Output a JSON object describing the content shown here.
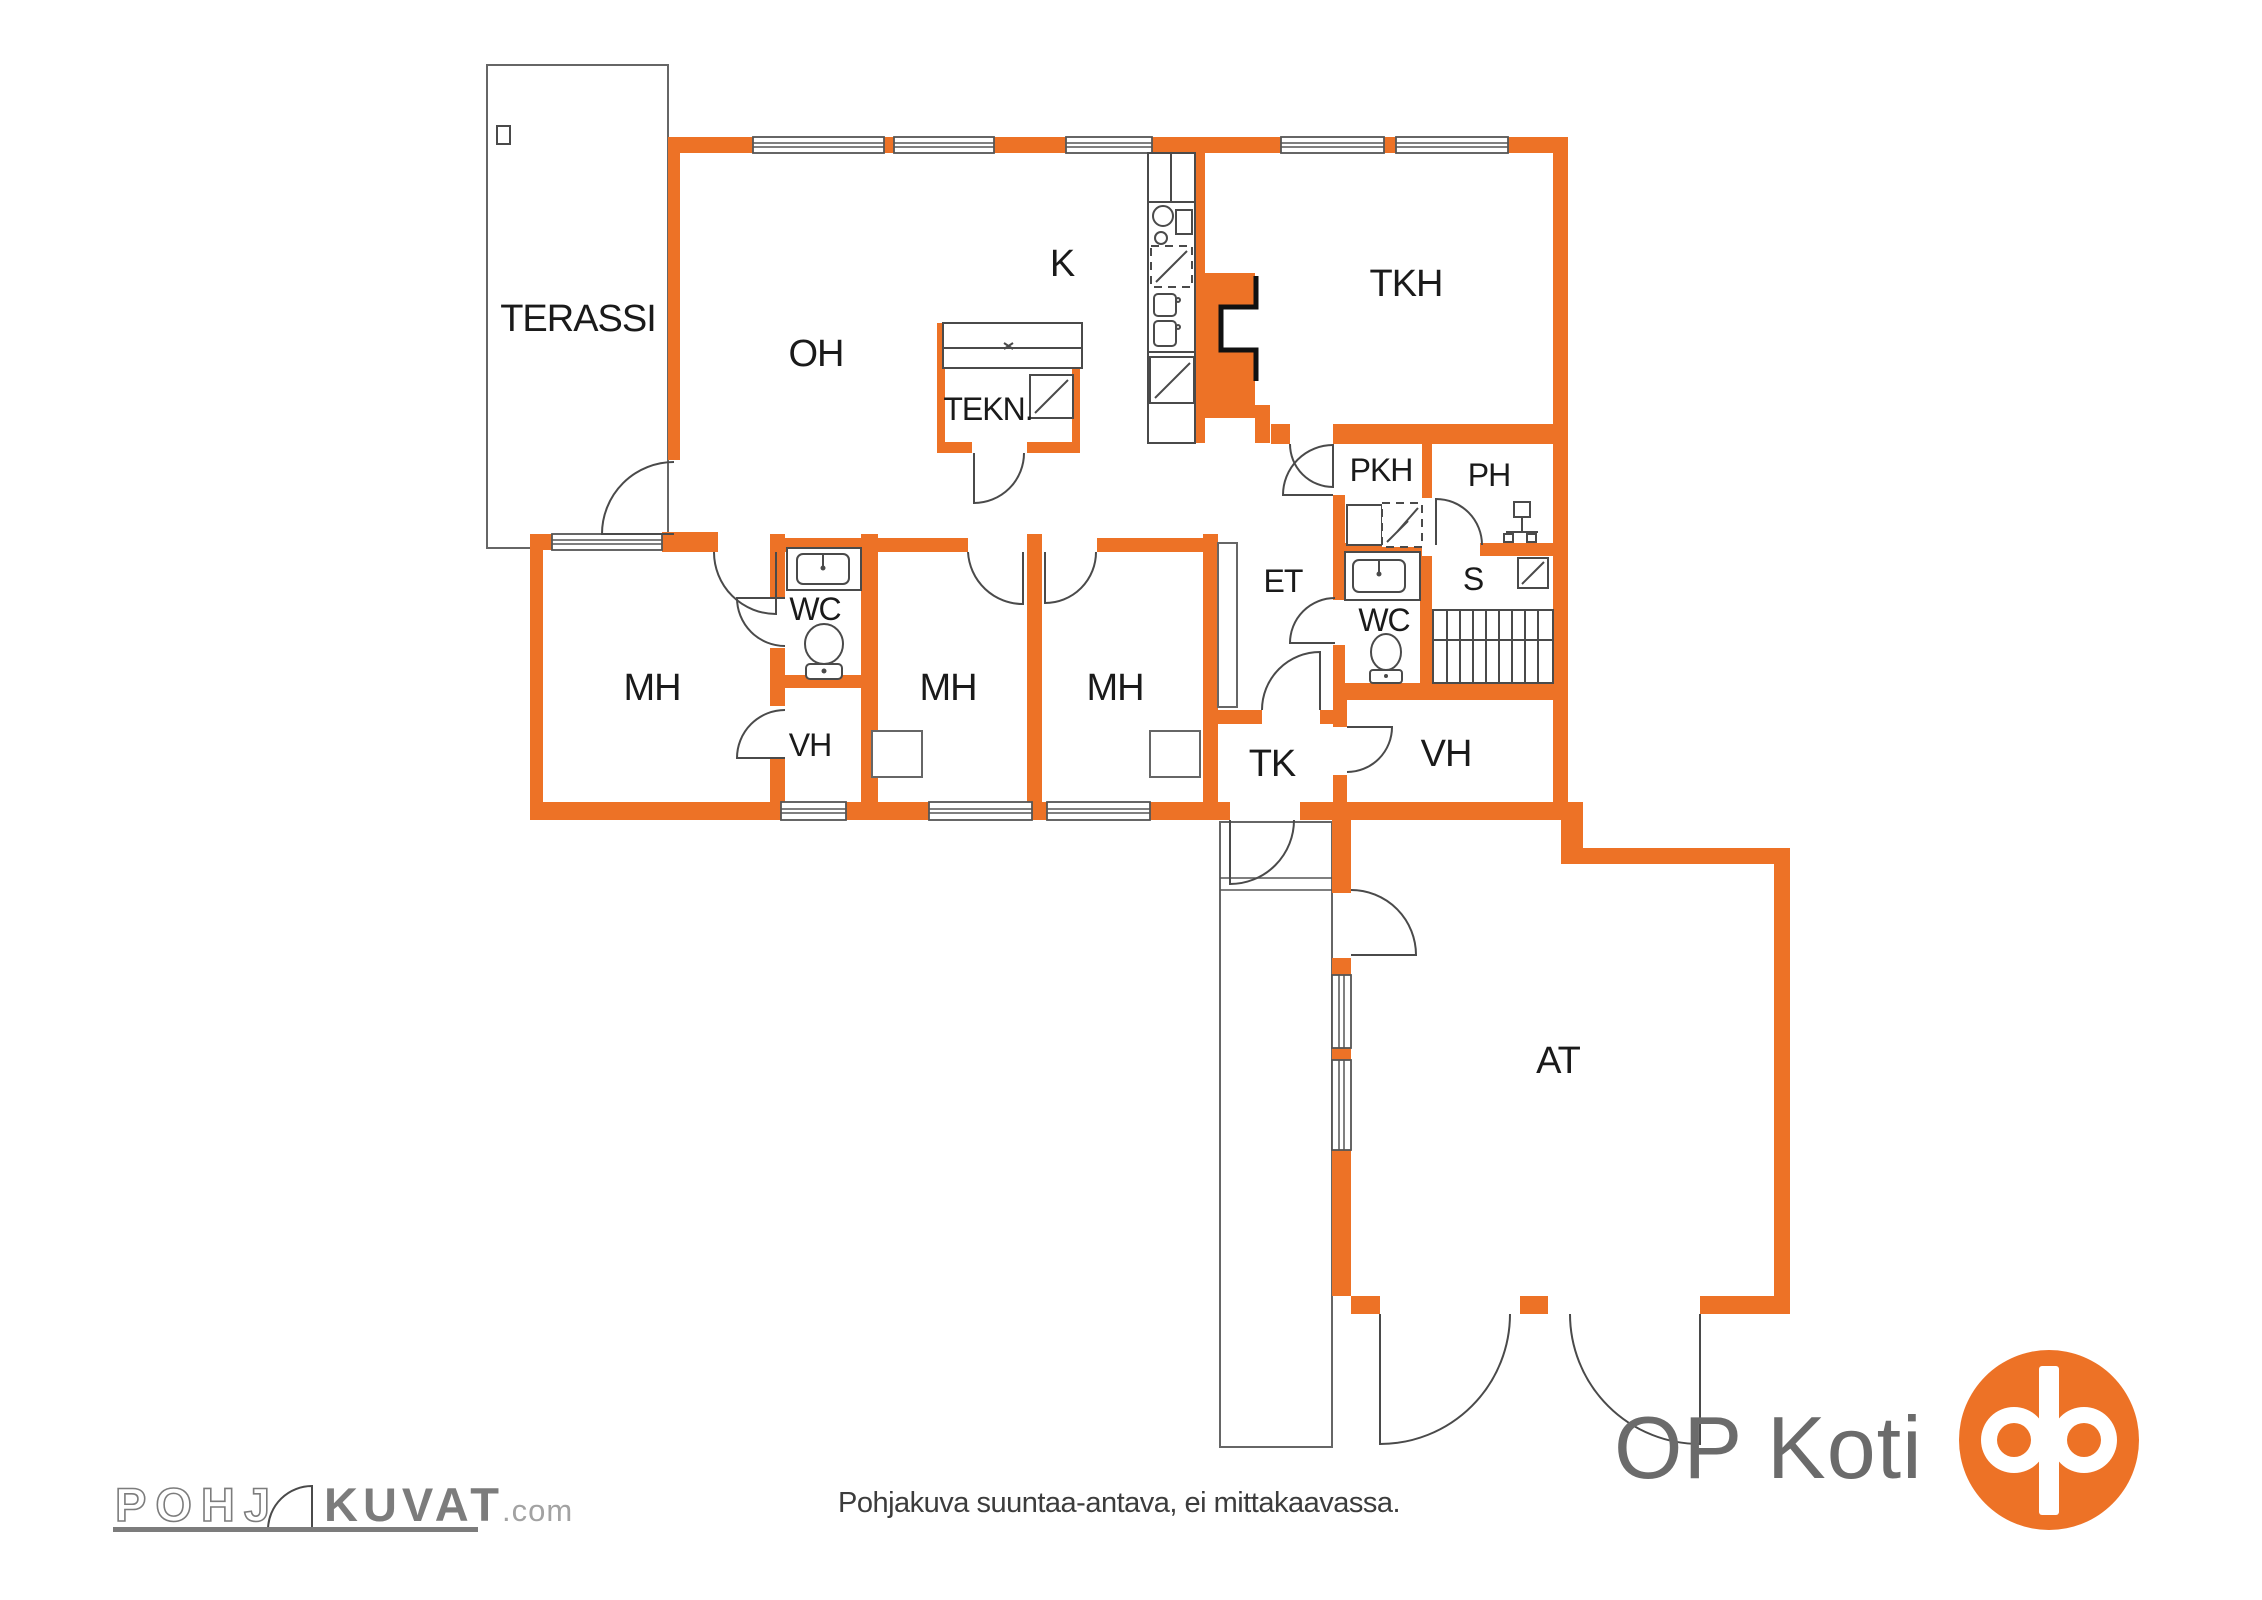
{
  "plan": {
    "rooms": [
      {
        "id": "terassi",
        "label": "TERASSI"
      },
      {
        "id": "oh",
        "label": "OH"
      },
      {
        "id": "k",
        "label": "K"
      },
      {
        "id": "tkh",
        "label": "TKH"
      },
      {
        "id": "tekn",
        "label": "TEKN."
      },
      {
        "id": "pkh",
        "label": "PKH"
      },
      {
        "id": "ph",
        "label": "PH"
      },
      {
        "id": "et",
        "label": "ET"
      },
      {
        "id": "wc_upper",
        "label": "WC"
      },
      {
        "id": "s",
        "label": "S"
      },
      {
        "id": "mh_master",
        "label": "MH"
      },
      {
        "id": "wc_master",
        "label": "WC"
      },
      {
        "id": "vh_master",
        "label": "VH"
      },
      {
        "id": "mh_middle",
        "label": "MH"
      },
      {
        "id": "mh_right",
        "label": "MH"
      },
      {
        "id": "tk",
        "label": "TK"
      },
      {
        "id": "vh_hall",
        "label": "VH"
      },
      {
        "id": "at",
        "label": "AT"
      }
    ]
  },
  "footer": {
    "disclaimer": "Pohjakuva suuntaa-antava, ei mittakaavassa."
  },
  "branding": {
    "pohjakuvat": {
      "part1": "POHJ",
      "part2": "KUVAT",
      "suffix": ".com"
    },
    "op": {
      "wordmark": "OP Koti"
    }
  },
  "colors": {
    "wall_orange": "#ED7226",
    "detail_line": "#4a4a4a",
    "label_text": "#1a1a1a",
    "pohjakuvat_gray": "#7c7c7c",
    "op_text_gray": "#6b6b6b",
    "op_orange": "#ED7226"
  }
}
